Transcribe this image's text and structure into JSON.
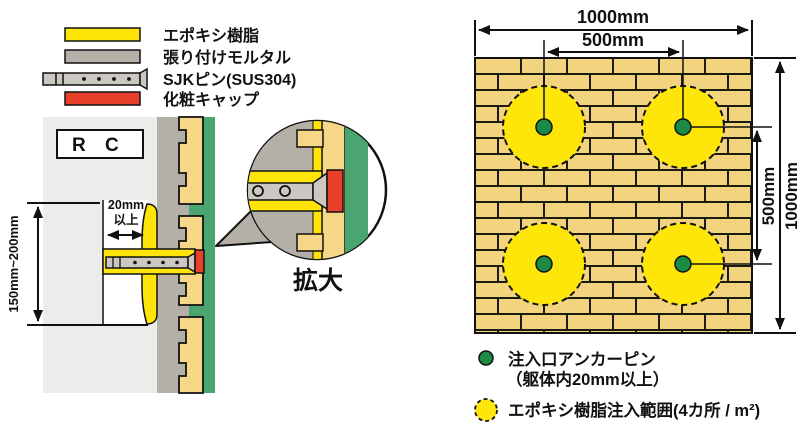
{
  "colors": {
    "epoxy_yellow": "#FFE40A",
    "mortar_gray": "#B5B0A7",
    "pin_gray": "#CBC8C1",
    "cap_red": "#E8402A",
    "rc_gray": "#ECECEA",
    "tile_tan": "#F6D687",
    "brick_tan": "#F2D47E",
    "surface_green": "#4AA571",
    "pin_dot_green": "#1B8A45",
    "injection_yellow": "#FFE60A"
  },
  "material_legend": {
    "items": [
      {
        "label": "エポキシ樹脂"
      },
      {
        "label": "張り付けモルタル"
      },
      {
        "label": "SJKピン(SUS304)"
      },
      {
        "label": "化粧キャップ"
      }
    ]
  },
  "section_view": {
    "rc_label": "R C",
    "embed_depth_line1": "20mm",
    "embed_depth_line2": "以上",
    "pin_length_range": "150mm~200mm",
    "magnified_label": "拡大"
  },
  "plan_view": {
    "width_total": "1000mm",
    "width_spacing": "500mm",
    "height_spacing": "500mm",
    "height_total": "1000mm"
  },
  "plan_legend": {
    "pin_label_line1": "注入口アンカーピン",
    "pin_label_line2": "（躯体内20mm以上）",
    "epoxy_label": "エポキシ樹脂注入範囲(4カ所 / m²)"
  }
}
